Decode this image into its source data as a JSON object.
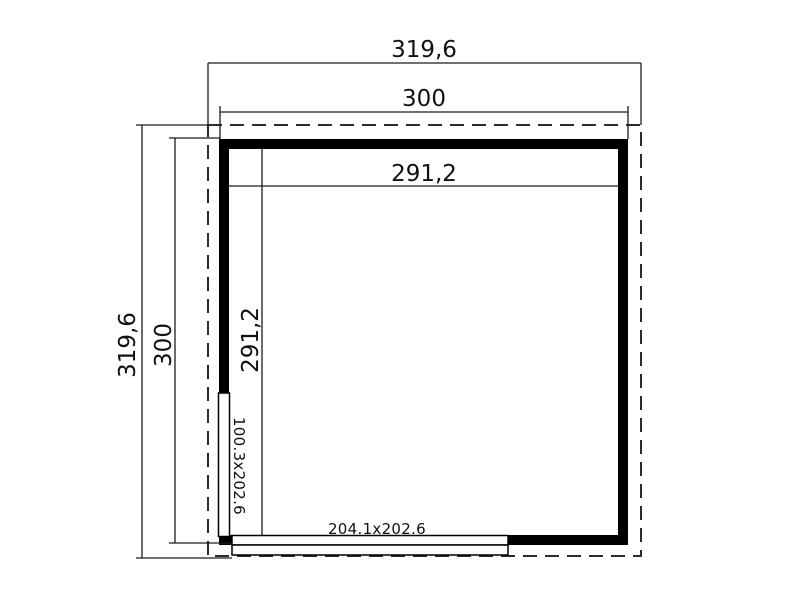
{
  "plan": {
    "title": "floor-plan",
    "top_dimensions": {
      "outer": "319,6",
      "wall": "300"
    },
    "left_dimensions": {
      "outer": "319,6",
      "wall": "300"
    },
    "interior_dimensions": {
      "width": "291,2",
      "height": "291,2"
    },
    "doors": {
      "side_door": "100.3x202.6",
      "front_door": "204.1x202.6"
    },
    "colors": {
      "background": "#ffffff",
      "wall": "#000000",
      "line": "#1c1c1c",
      "roof_outline": "#2b2b2b",
      "text": "#111111"
    }
  }
}
